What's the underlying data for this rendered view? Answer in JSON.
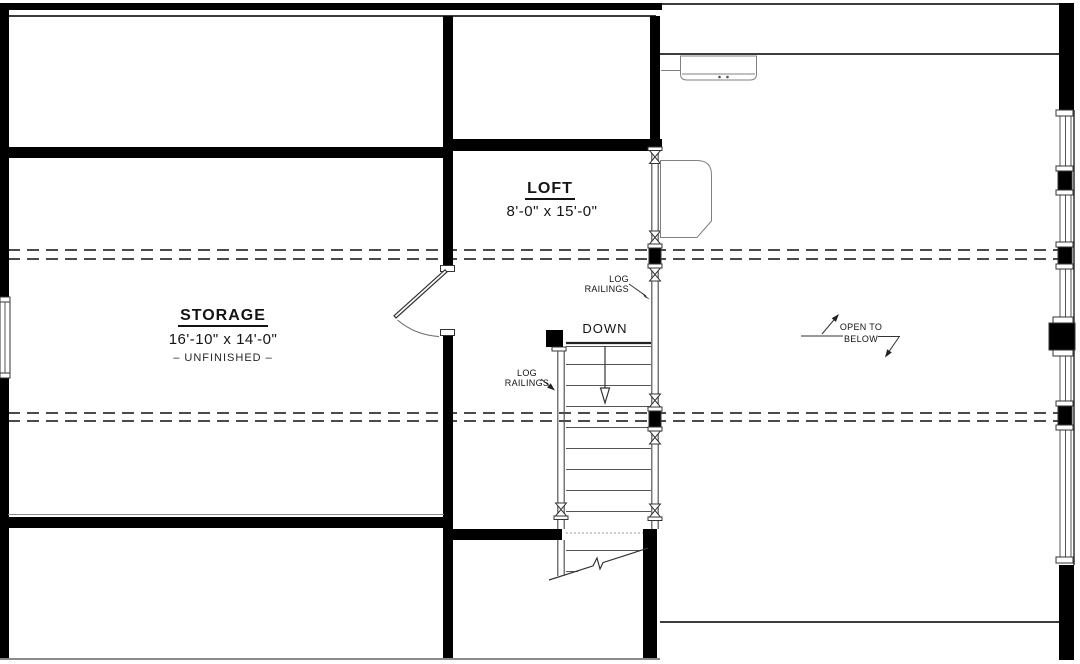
{
  "drawing": {
    "rooms": {
      "loft": {
        "name": "LOFT",
        "dimensions": "8'-0\" x 15'-0\""
      },
      "storage": {
        "name": "STORAGE",
        "dimensions": "16'-10\" x 14'-0\"",
        "note": "– UNFINISHED –"
      }
    },
    "stairs": {
      "direction_label": "DOWN"
    },
    "railings": {
      "label_line1": "LOG",
      "label_line2": "RAILINGS"
    },
    "open_to_below": {
      "line1": "OPEN TO",
      "line2": "BELOW"
    },
    "colors": {
      "wall": "#000000",
      "thin_line": "#3d3d3d",
      "dashed_line": "#4b4b4b",
      "fixture_line": "#808080",
      "text": "#141414"
    }
  }
}
